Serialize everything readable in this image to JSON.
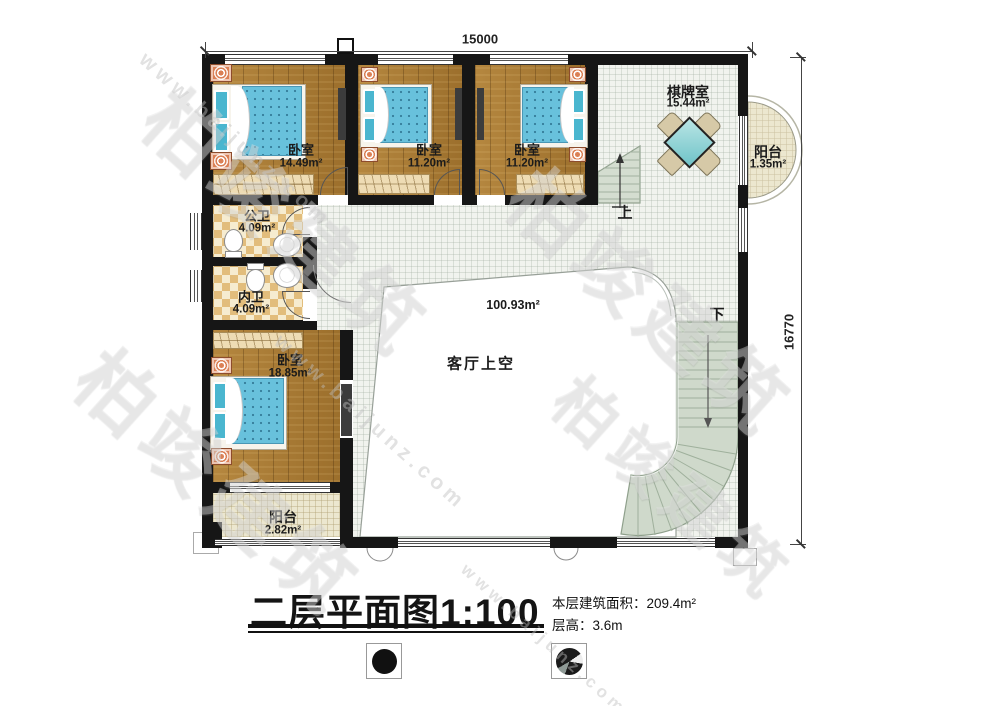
{
  "watermark": {
    "brand": "柏竣建筑",
    "site": "www.baijunz.com"
  },
  "dimensions": {
    "width": "15000",
    "height": "16770"
  },
  "rooms": {
    "bedroom1": {
      "name": "卧室",
      "area": "14.49m²"
    },
    "bedroom2": {
      "name": "卧室",
      "area": "11.20m²"
    },
    "bedroom3": {
      "name": "卧室",
      "area": "11.20m²"
    },
    "chess": {
      "name": "棋牌室",
      "area": "15.44m²"
    },
    "balcony_right": {
      "name": "阳台",
      "area": "1.35m²"
    },
    "bath_public": {
      "name": "公卫",
      "area": "4.09m²"
    },
    "bath_private": {
      "name": "内卫",
      "area": "4.09m²"
    },
    "bedroom4": {
      "name": "卧室",
      "area": "18.85m²"
    },
    "balcony_bottom": {
      "name": "阳台",
      "area": "2.82m²"
    },
    "living_void": {
      "name": "客厅上空",
      "area": "100.93m²"
    }
  },
  "stairs": {
    "up": "上",
    "down": "下"
  },
  "title_block": {
    "title": "二层平面图",
    "scale": "1:100",
    "floor_area_label": "本层建筑面积：",
    "floor_area_value": "209.4m²",
    "floor_height_label": "层高：",
    "floor_height_value": "3.6m"
  }
}
